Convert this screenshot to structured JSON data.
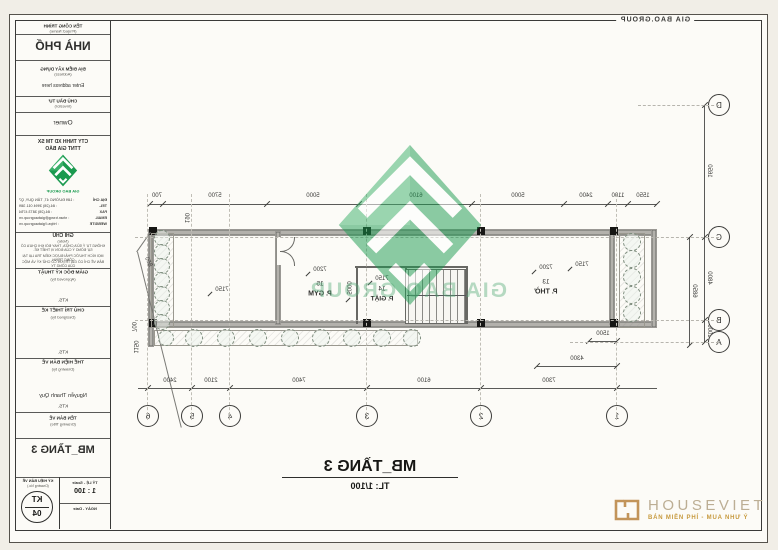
{
  "colors": {
    "logo_green": "#1a9a4f",
    "logo_green_light": "#3bb06a",
    "watermark_green": "#7cc89a",
    "gold": "#c79a3f"
  },
  "sheet": {
    "corner_brand": "GIA BAO.GROUP",
    "plan_title": "MB_TẦNG 3",
    "plan_scale": "TL: 1/100"
  },
  "watermark": {
    "brand": "GIA BAO GROUP"
  },
  "plan": {
    "grid_cols": [
      "1",
      "2",
      "3",
      "4",
      "5",
      "6"
    ],
    "grid_rows": [
      "D",
      "C",
      "B",
      "A"
    ],
    "dims_top": [
      "1550",
      "1100",
      "2400",
      "5000",
      "6100",
      "5000",
      "5700",
      "700"
    ],
    "dims_grid": [
      "7300",
      "6100",
      "7400",
      "2100",
      "2400"
    ],
    "dims_left": {
      "d_c": "1650",
      "c_b": "4800",
      "b_a": "1000",
      "overall": "6850"
    },
    "dims_misc": {
      "m1500": "1500",
      "m4300": "4300",
      "m850": "850",
      "m700": "700",
      "m1150": "1150",
      "m190": "190"
    },
    "rooms": [
      {
        "no": "13",
        "name": "P. THỜ",
        "dim": "7200"
      },
      {
        "no": "14",
        "name": "P. GIẶT",
        "dim": "7150"
      },
      {
        "no": "15",
        "name": "P. GYM",
        "dim": "7200"
      }
    ],
    "left_room_dim": "7150",
    "balcony_dim": "7150",
    "stair_dim": "5000"
  },
  "title_block": {
    "project": {
      "label": "TÊN CÔNG TRÌNH",
      "sublabel": "(Project Name)",
      "value": "NHÀ PHỐ"
    },
    "address": {
      "label": "ĐỊA ĐIỂM XÂY DỰNG",
      "sublabel": "(Address)",
      "value": "Enter address here"
    },
    "investor": {
      "label": "CHỦ ĐẦU TƯ",
      "sublabel": "(Investor)",
      "value": "Owner"
    },
    "company": {
      "name_line1": "CTY TNHH XD TM SX",
      "name_line2": "TTNT GIA BẢO",
      "brand": "GIA BAO GROUP",
      "contacts": [
        {
          "label": "ĐỊA CHỈ",
          "value": ": 189 ĐƯỜNG 47, TÂN QUY, Q7"
        },
        {
          "label": "TEL.",
          "value": ": 84.(28) 3994 011 389"
        },
        {
          "label": "FAX",
          "value": ": 84.(28) 3873 4754"
        },
        {
          "label": "EMAIL",
          "value": ": nhan.trang@giabaogroup.vn"
        },
        {
          "label": "WEBSITE",
          "value": ": https://giabaogroup.vn"
        }
      ]
    },
    "note": {
      "label": "GHI CHÚ",
      "sublabel": "(Note)",
      "line1": "KHÔNG TỰ Ý SỬA CHỮA, THAY ĐỔI KHI CHƯA CÓ SỰ ĐỒNG Ý CỦA ĐƠN VỊ THIẾT KẾ.",
      "line2": "MỌI KÍCH THƯỚC PHẢI ĐƯỢC KIỂM TRA LẠI TẠI CÔNG TRÌNH.",
      "line3": "BẢN VẼ CHỈ CÓ GIÁ TRỊ KHI CÓ CHỮ KÝ VÀ MỘC CỦA CÔNG TY."
    },
    "sign1": {
      "label": "GIÁM ĐỐC KỸ THUẬT",
      "sublabel": "(Approved by)",
      "title": "KTS."
    },
    "sign2": {
      "label": "CHỦ TRÌ THIẾT KẾ",
      "sublabel": "(Designed by)",
      "title": "KTS."
    },
    "sign3": {
      "label": "THỂ HIỆN BẢN VẼ",
      "sublabel": "(Drawing by)",
      "name": "Nguyễn Thanh Quy",
      "title": "KTS."
    },
    "drawing_title": {
      "label": "TÊN BẢN VẼ",
      "sublabel": "(Drawing Title)",
      "value": "MB_TẦNG 3"
    },
    "drawing_no": {
      "label": "KÝ HIỆU BẢN VẼ",
      "sublabel": "(Drawing No.)",
      "code": "KT",
      "number": "04"
    },
    "scale": {
      "label": "TỶ LỆ - Scale",
      "value": "1 : 100"
    },
    "date": {
      "label": "NGÀY - Date"
    }
  },
  "footer_logo": {
    "name": "HOUSEVIET",
    "tagline": "BÁN MIỄN PHÍ - MUA NHƯ Ý"
  }
}
